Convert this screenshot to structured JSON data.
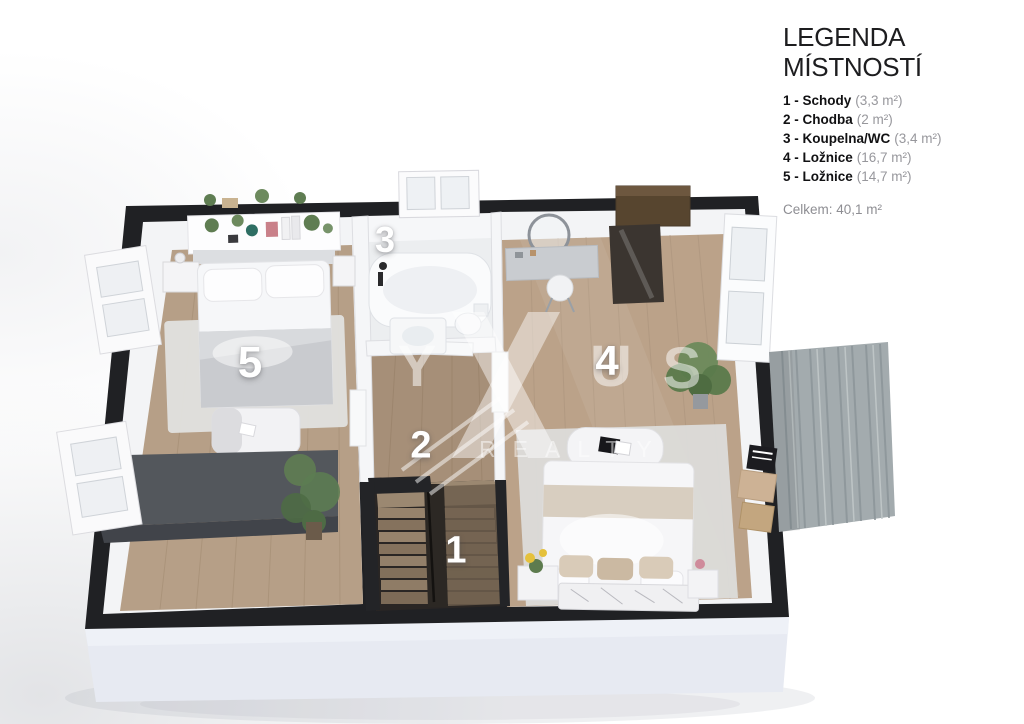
{
  "legend": {
    "title": "LEGENDA MÍSTNOSTÍ",
    "items": [
      {
        "label": "1 - Schody",
        "area": "(3,3 m²)"
      },
      {
        "label": "2 - Chodba",
        "area": "(2 m²)"
      },
      {
        "label": "3 - Koupelna/WC",
        "area": "(3,4 m²)"
      },
      {
        "label": "4 - Ložnice",
        "area": "(16,7 m²)"
      },
      {
        "label": "5 - Ložnice",
        "area": "(14,7 m²)"
      }
    ],
    "total": "Celkem: 40,1 m²"
  },
  "floorplan": {
    "room_labels": [
      "1",
      "2",
      "3",
      "4",
      "5"
    ],
    "watermark": {
      "letters": [
        "Y",
        "U",
        "S"
      ],
      "subtext": "REALTY"
    }
  },
  "colors": {
    "wall": "#202124",
    "wood_floor": "#b69f87",
    "bath_floor": "#eceef0",
    "plinth": "#e7eaf2",
    "rug": "#dededc",
    "terrace_mat": "#a3abae",
    "sideboard": "#53575c",
    "wardrobe": "#57452f",
    "plant": "#5f7d52",
    "label_text": "#ffffff",
    "legend_text": "#111113",
    "legend_muted": "#97979c"
  }
}
